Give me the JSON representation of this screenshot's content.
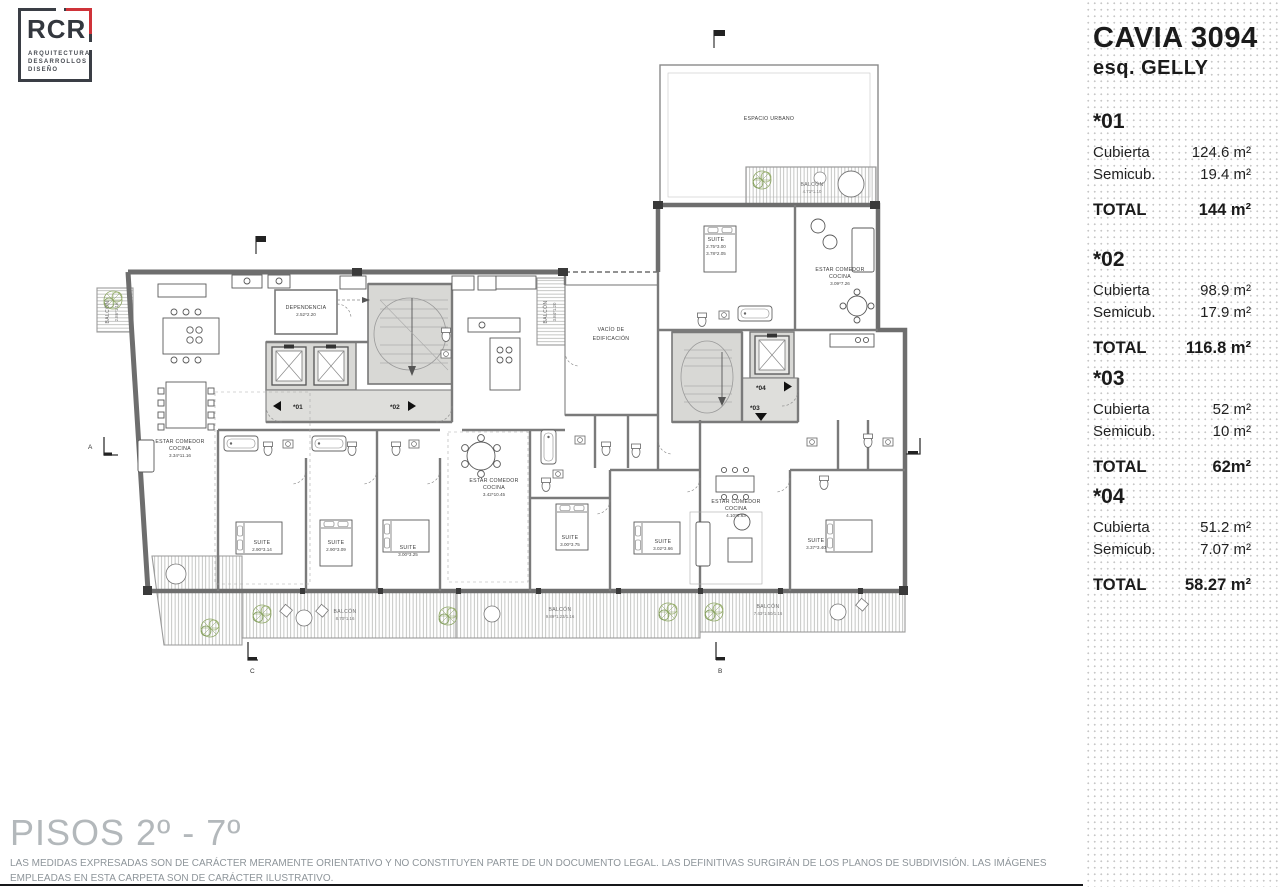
{
  "logo": {
    "brand": "RCR",
    "tagline": [
      "ARQUITECTURA",
      "DESARROLLOS",
      "DISEÑO"
    ],
    "accent_color": "#cf3339"
  },
  "sidebar": {
    "title": "CAVIA 3094",
    "subtitle": "esq. GELLY",
    "units": [
      {
        "id": "*01",
        "rows": [
          {
            "label": "Cubierta",
            "value": "124.6 m²"
          },
          {
            "label": "Semicub.",
            "value": "19.4 m²"
          }
        ],
        "total_label": "TOTAL",
        "total_value": "144 m²"
      },
      {
        "id": "*02",
        "rows": [
          {
            "label": "Cubierta",
            "value": "98.9 m²"
          },
          {
            "label": "Semicub.",
            "value": "17.9 m²"
          }
        ],
        "total_label": "TOTAL",
        "total_value": "116.8 m²"
      },
      {
        "id": "*03",
        "rows": [
          {
            "label": "Cubierta",
            "value": "52 m²"
          },
          {
            "label": "Semicub.",
            "value": "10 m²"
          }
        ],
        "total_label": "TOTAL",
        "total_value": "62m²"
      },
      {
        "id": "*04",
        "rows": [
          {
            "label": "Cubierta",
            "value": "51.2 m²"
          },
          {
            "label": "Semicub.",
            "value": "7.07 m²"
          }
        ],
        "total_label": "TOTAL",
        "total_value": "58.27 m²"
      }
    ]
  },
  "footer": {
    "title": "PISOS 2º - 7º",
    "disclaimer": "LAS MEDIDAS EXPRESADAS SON DE CARÁCTER MERAMENTE ORIENTATIVO Y NO CONSTITUYEN PARTE DE UN DOCUMENTO LEGAL. LAS DEFINITIVAS SURGIRÁN DE LOS PLANOS DE SUBDIVISIÓN. LAS IMÁGENES EMPLEADAS EN ESTA CARPETA SON DE CARÁCTER ILUSTRATIVO."
  },
  "plan": {
    "espacio_urbano": "ESPACIO URBANO",
    "vacio": {
      "l1": "VACÍO DE",
      "l2": "EDIFICACIÓN"
    },
    "dependencia": {
      "l1": "DEPENDENCIA",
      "dims": "2.52*2.20"
    },
    "estar_left": {
      "l1": "ESTAR COMEDOR",
      "l2": "COCINA",
      "dims": "3.34*11.16"
    },
    "estar_mid": {
      "l1": "ESTAR COMEDOR",
      "l2": "COCINA",
      "dims": "3.42*10.45"
    },
    "estar_right": {
      "l1": "ESTAR COMEDOR",
      "l2": "COCINA",
      "dims": "4.10*6.63"
    },
    "estar_top": {
      "l1": "ESTAR COMEDOR",
      "l2": "COCINA",
      "dims": "3.09*7.26"
    },
    "suite_top": {
      "l1": "SUITE",
      "dims": "2.75*3.00",
      "dims2": "3.78*2.05"
    },
    "suite_1": {
      "l1": "SUITE",
      "dims": "2.90*3.14"
    },
    "suite_2": {
      "l1": "SUITE",
      "dims": "2.90*3.09"
    },
    "suite_3": {
      "l1": "SUITE",
      "dims": "3.00*3.25"
    },
    "suite_4": {
      "l1": "SUITE",
      "dims": "3.00*3.75"
    },
    "suite_5": {
      "l1": "SUITE",
      "dims": "3.02*3.66"
    },
    "suite_6": {
      "l1": "SUITE",
      "dims": "3.37*3.40"
    },
    "balcon_left": {
      "l1": "BALCÓN",
      "dims": "2.86*1.16"
    },
    "balcon_mid": {
      "l1": "BALCÓN",
      "dims": "3.84*1.20"
    },
    "balcon_tr": {
      "l1": "BALCÓN",
      "dims": "4.71*1.10"
    },
    "balcon_b1": {
      "l1": "BALCÓN",
      "dims": "8.70*1.16"
    },
    "balcon_b2": {
      "l1": "BALCÓN",
      "dims": "9.89*1.23/1.16"
    },
    "balcon_b3": {
      "l1": "BALCÓN",
      "dims": "7.43*1.50/1.16"
    },
    "units": {
      "u1": "*01",
      "u2": "*02",
      "u3": "*03",
      "u4": "*04"
    },
    "sections": {
      "a": "A",
      "b": "B",
      "c": "C"
    }
  }
}
